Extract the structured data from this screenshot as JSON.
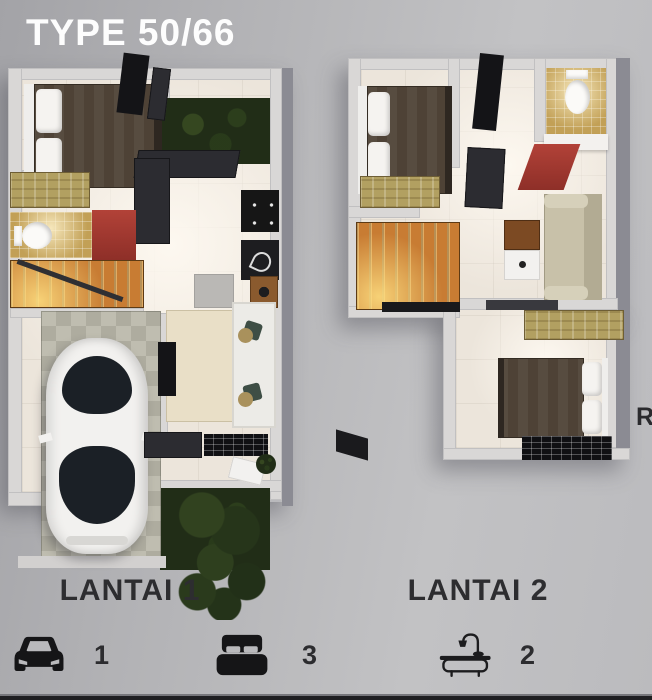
{
  "header": {
    "title": "TYPE 50/66"
  },
  "floor_plans": [
    {
      "id": "lantai-1",
      "label": "LANTAI 1"
    },
    {
      "id": "lantai-2",
      "label": "LANTAI 2"
    }
  ],
  "legend": {
    "items": [
      {
        "icon": "car-icon",
        "count": "1"
      },
      {
        "icon": "bed-icon",
        "count": "3"
      },
      {
        "icon": "bathtub-icon",
        "count": "2"
      }
    ]
  },
  "watermark": {
    "text": "RS"
  },
  "colors": {
    "background": "#b6b6b9",
    "title": "#fdfdfd",
    "floor_label": "#2d2d30",
    "legend_icon": "#151517",
    "plan_floor": "#efe8df",
    "plan_wall": "#d9d7d6",
    "garden_green": "#212d17",
    "stair_orange": "#d9893b",
    "bed_brown": "#4e4236",
    "wardrobe_tan": "#b2a061",
    "accent_red": "#a93a31",
    "bath_tile_gold": "#c2a056",
    "sofa_beige": "#c8c1a9",
    "carport_tile": "#b3b1a4"
  }
}
